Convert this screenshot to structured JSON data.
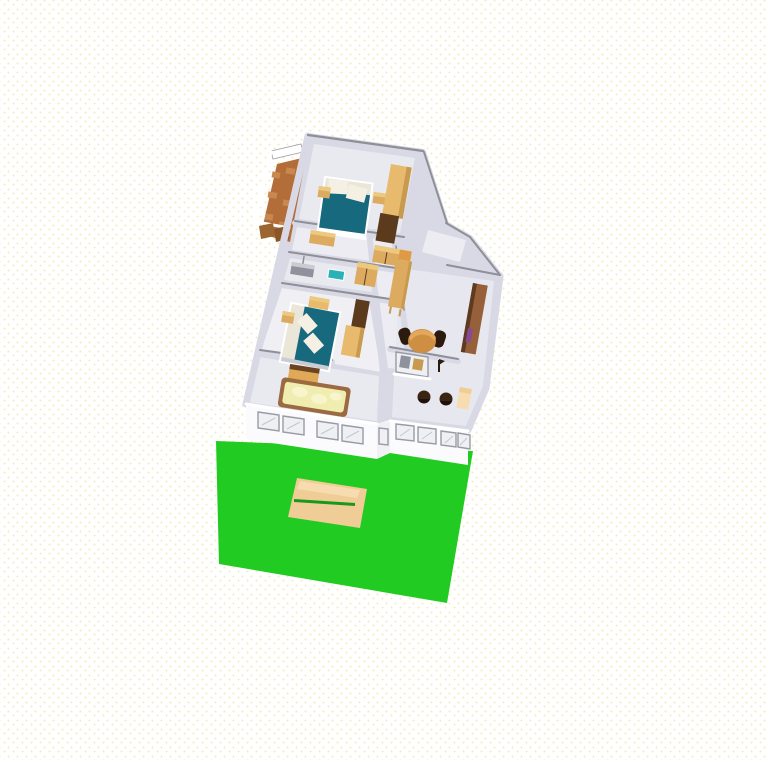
{
  "app": {
    "name": "3D home plan render",
    "view_label": "aerial 3D view"
  },
  "scene": {
    "ground": {
      "label": "garden lawn",
      "patch_label": "sand patch with mower line"
    },
    "house": {
      "front_window_count": 9,
      "rooms": [
        {
          "label": "bedroom-top",
          "furniture": [
            "double bed with teal duvet and two white pillows",
            "nightstand left",
            "nightstand right",
            "tall wardrobe",
            "low cabinet"
          ]
        },
        {
          "label": "balcony",
          "furniture": [
            "terracotta tiled floor",
            "white railing",
            "wooden crates"
          ]
        },
        {
          "label": "corridor-bath",
          "furniture": [
            "grey washbasin unit",
            "teal sink",
            "wood cabinet",
            "wood cabinet"
          ]
        },
        {
          "label": "bedroom-bottom",
          "furniture": [
            "double bed with teal duvet and two white pillows",
            "nightstand",
            "dresser",
            "dark chest",
            "wardrobe",
            "single bed with yellow cover and wood headboard"
          ]
        },
        {
          "label": "hallway",
          "furniture": [
            "tall wardrobe on legs"
          ]
        },
        {
          "label": "dining-living",
          "furniture": [
            "round wooden table",
            "dark chair left",
            "dark chair right",
            "tall brown cabinet",
            "purple item"
          ]
        },
        {
          "label": "kitchen",
          "furniture": [
            "counter with pass-through window",
            "grey appliance",
            "stool",
            "stool",
            "small side table",
            "floor lamp"
          ]
        }
      ]
    }
  },
  "colors": {
    "lawn": "#22cb22",
    "lawnSeam": "#18991c",
    "sand": "#f0cd96",
    "sandLight": "#f6dcae",
    "wall": "#d9d9e5",
    "wallCap": "#8f8f98",
    "wallLight": "#ffffff",
    "floorA": "#e9e9f0",
    "floorB": "#f0f0f4",
    "floorC": "#e7e7ef",
    "floorD": "#ececf2",
    "face": "#fbfbfd",
    "faceShade": "#f0f0f5",
    "windowFrame": "#9a9aa4",
    "windowGlass": "#eef0f4",
    "glassStreak": "#c2c6ce",
    "teal": "#17697d",
    "mattress": "#eae7d8",
    "pillow": "#f4f1e4",
    "woodLight": "#e7ba6e",
    "wood": "#dcab60",
    "woodMid": "#c89a50",
    "woodDark": "#5c3b1d",
    "woodTopLight": "#ecc97e",
    "tile": "#b26d39",
    "tileLight": "#c98850",
    "crate": "#9a6530",
    "crateDark": "#8a5628",
    "bedYellow": "#f0edb0",
    "bedYellowLight": "#f8f5cc",
    "bedFrame": "#9b6a40",
    "headboard": "#dfa958",
    "headboardTop": "#6b4423",
    "tableWood": "#cf8f42",
    "tableTop": "#e2a85c",
    "chair": "#2b1a0d",
    "stool": "#3a2413",
    "stoolDark": "#1e1208",
    "sinkGray": "#8f929c",
    "sinkTop": "#c9ccd4",
    "tealSink": "#28b2b6",
    "cabinetBrown": "#95603a",
    "cabinetBrownDark": "#5e3a20",
    "orangeTop": "#e09a44",
    "purple": "#8a4898",
    "white": "#ffffff"
  }
}
